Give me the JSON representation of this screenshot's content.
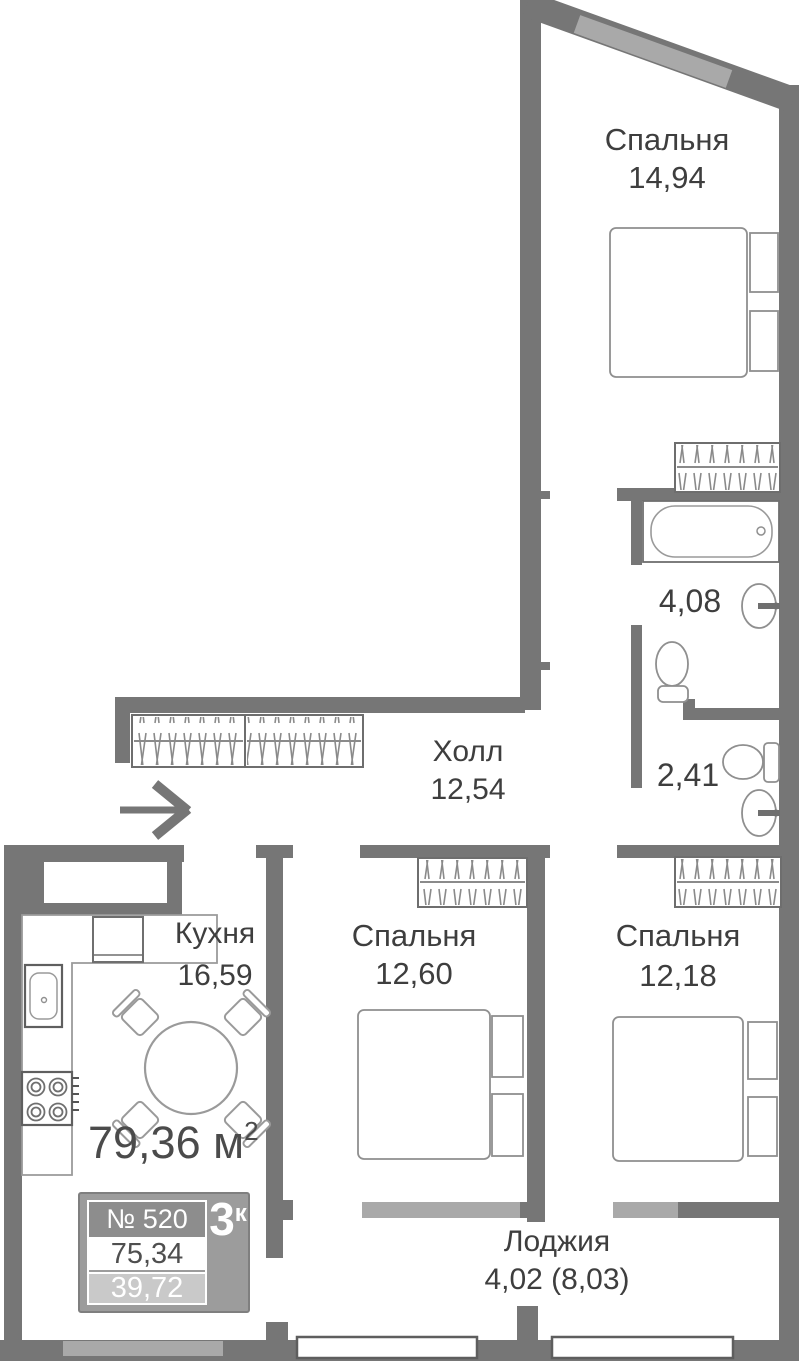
{
  "rooms": {
    "bedroom_top": {
      "name": "Спальня",
      "area": "14,94"
    },
    "hall": {
      "name": "Холл",
      "area": "12,54"
    },
    "bathroom": {
      "area": "4,08"
    },
    "wc": {
      "area": "2,41"
    },
    "kitchen": {
      "name": "Кухня",
      "area": "16,59"
    },
    "bedroom_mid": {
      "name": "Спальня",
      "area": "12,60"
    },
    "bedroom_right": {
      "name": "Спальня",
      "area": "12,18"
    },
    "loggia": {
      "name": "Лоджия",
      "area": "4,02 (8,03)"
    }
  },
  "summary": {
    "total_area": "79,36",
    "unit": " м",
    "unit_sup": "2"
  },
  "card": {
    "number": "№ 520",
    "rooms_count": "3",
    "rooms_count_sup": "к",
    "area_living": "75,34",
    "area_secondary": "39,72"
  },
  "colors": {
    "wall": "#767676",
    "glass": "#a9a9a9",
    "text": "#3e3e3e",
    "furniture_stroke": "#8f8f8f",
    "card_bg": "#9c9c9c",
    "card_dark_box": "#8d8d8d",
    "card_light_box": "#c9c9c9"
  }
}
